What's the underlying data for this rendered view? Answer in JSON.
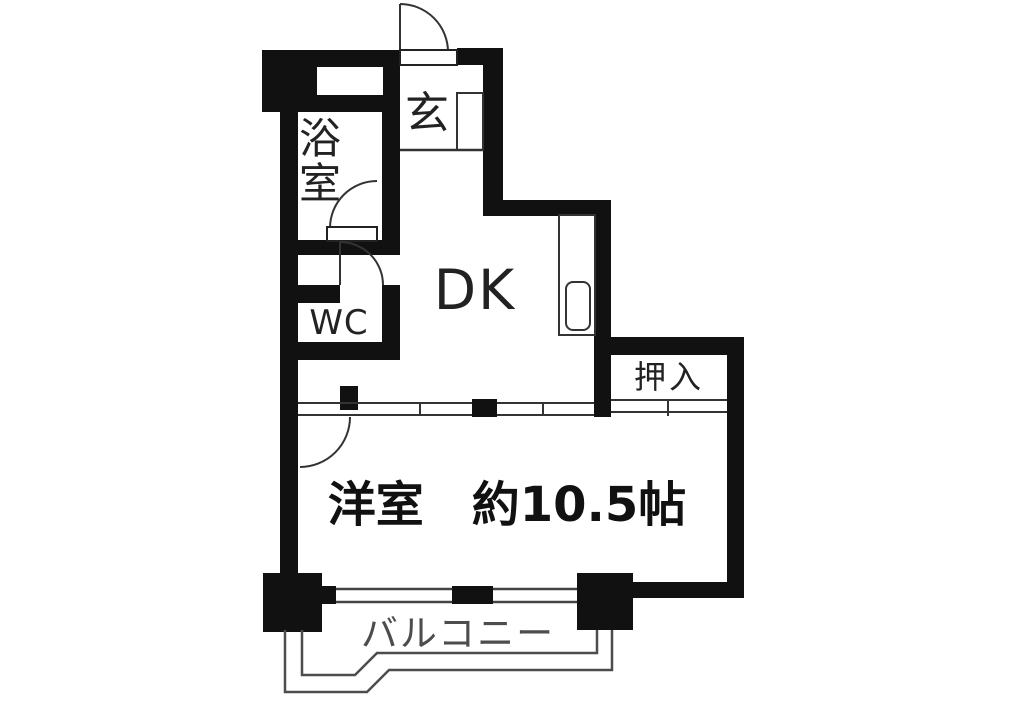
{
  "figure": {
    "kind": "apartment-floor-plan"
  },
  "rooms": {
    "genkan": {
      "label": "玄"
    },
    "bathroom": {
      "label": "浴室",
      "char1": "浴",
      "char2": "室"
    },
    "wc": {
      "label": "WC"
    },
    "dk": {
      "label": "DK"
    },
    "closet": {
      "label": "押入"
    },
    "main": {
      "label": "洋室　約10.5帖",
      "size_tatami": "約10.5帖"
    },
    "balcony": {
      "label": "バルコニー"
    }
  },
  "colors": {
    "wall": "#111111",
    "thin_line": "#333333",
    "light_line": "#555555",
    "background": "#ffffff",
    "text": "#222222"
  }
}
